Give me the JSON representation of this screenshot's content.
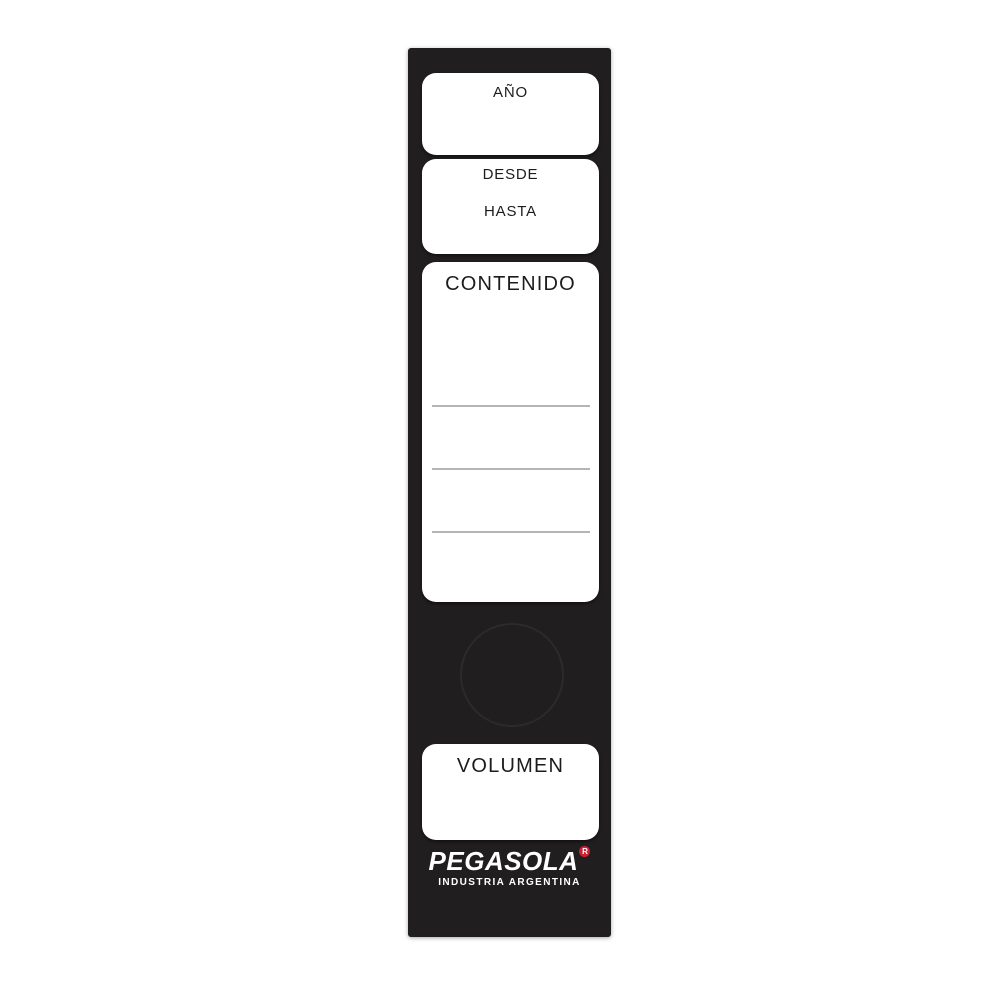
{
  "label": {
    "type": "binder-spine-label",
    "fields": {
      "year": {
        "label": "AÑO"
      },
      "period": {
        "from_label": "DESDE",
        "to_label": "HASTA"
      },
      "contents": {
        "label": "CONTENIDO",
        "ruled_lines": 3
      },
      "volume": {
        "label": "VOLUMEN"
      }
    },
    "brand": {
      "name": "PEGASOLA",
      "mark_letter": "R",
      "tagline": "INDUSTRIA ARGENTINA"
    },
    "colors": {
      "spine_black": "#211e1f",
      "box_white": "#ffffff",
      "rule_gray": "#b5b5b5",
      "brand_red": "#cb2233",
      "text_black": "#1c1c1c"
    }
  }
}
